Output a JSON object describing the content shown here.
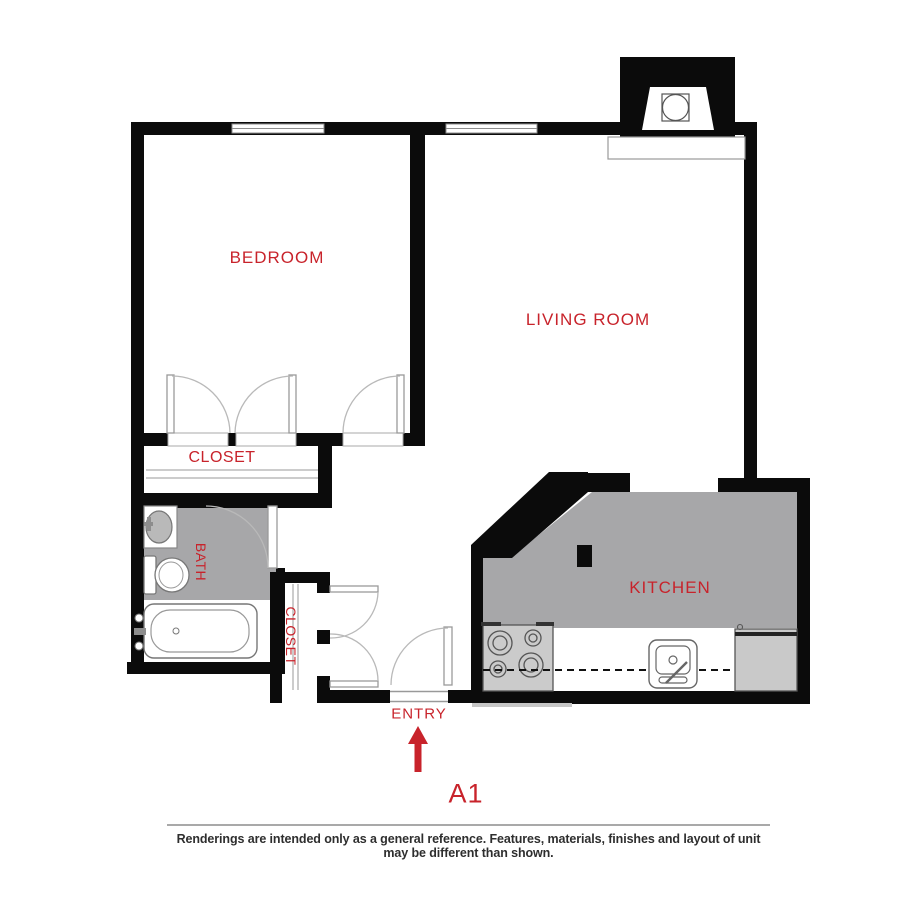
{
  "floor_plan": {
    "unit_label": "A1",
    "labels": {
      "bedroom": "BEDROOM",
      "living_room": "LIVING ROOM",
      "kitchen": "KITCHEN",
      "bath": "BATH",
      "closet_bedroom": "CLOSET",
      "closet_entry": "CLOSET",
      "entry": "ENTRY"
    },
    "entry_arrow_direction": "up",
    "colors": {
      "label_red": "#c8232b",
      "wall_black": "#0b0b0b",
      "floor_gray": "#a7a7a9",
      "appliance_gray": "#cbcbcb",
      "door_arc_gray": "#b9b9b9",
      "disclaimer_gray": "#2e2e2e"
    },
    "disclaimer": "Renderings are intended only as a general reference. Features, materials, finishes and layout of unit may be different than shown."
  }
}
